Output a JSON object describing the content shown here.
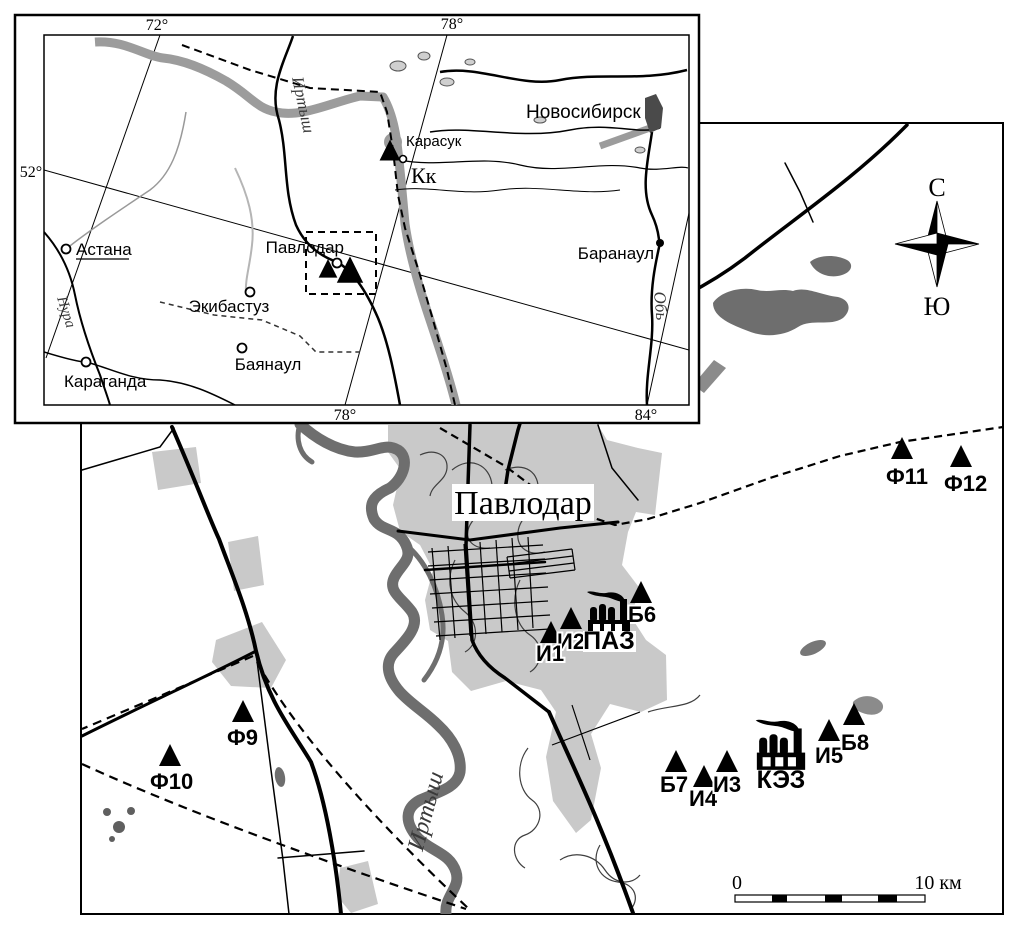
{
  "inset": {
    "grid": {
      "top_left": "72°",
      "top_right": "78°",
      "left": "52°",
      "bottom_left": "78°",
      "bottom_right": "84°"
    },
    "cities": {
      "astana": "Астана",
      "karaganda": "Караганда",
      "ekibastuz": "Экибастуз",
      "bayanaul": "Баянаул",
      "pavlodar": "Павлодар",
      "karasuk": "Карасук",
      "karasuk_abbr": "Кк",
      "novosibirsk": "Новосибирск",
      "barnaul": "Баранаул"
    },
    "rivers": {
      "irtysh": "Иртыш",
      "nura": "Нура",
      "ob": "Обь"
    }
  },
  "main_map": {
    "city_label": "Павлодар",
    "river_label": "Иртыш",
    "compass": {
      "north": "С",
      "south": "Ю"
    },
    "scale_bar": {
      "start": "0",
      "end": "10 км"
    },
    "factories": [
      {
        "label": "ПАЗ"
      },
      {
        "label": "КЭЗ"
      }
    ],
    "stations": [
      {
        "label": "Ф11"
      },
      {
        "label": "Ф12"
      },
      {
        "label": "Б6"
      },
      {
        "label": "И2"
      },
      {
        "label": "И1"
      },
      {
        "label": "Б7"
      },
      {
        "label": "И4"
      },
      {
        "label": "И3"
      },
      {
        "label": "И5"
      },
      {
        "label": "Б8"
      },
      {
        "label": "Ф9"
      },
      {
        "label": "Ф10"
      }
    ]
  },
  "colors": {
    "urban_gray": "#c9c9c9",
    "water_gray": "#6e6e6e",
    "valley_gray": "#9c9c9c",
    "ink": "#000000"
  }
}
